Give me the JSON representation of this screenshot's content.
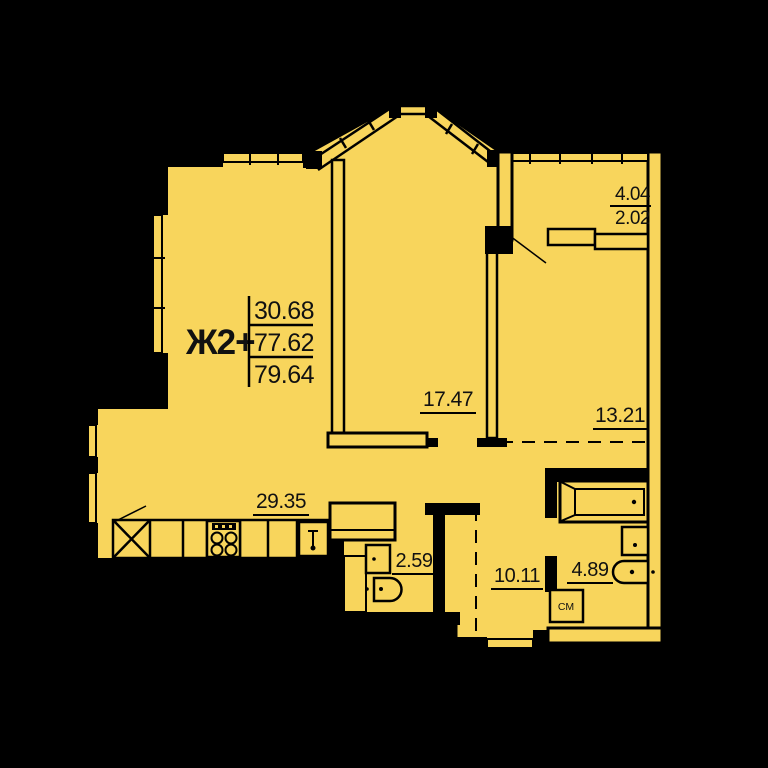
{
  "plan": {
    "apartment_label": "Ж2+",
    "area_summary": {
      "living": "30.68",
      "total": "77.62",
      "total_with_balcony": "79.64"
    },
    "rooms": [
      {
        "name": "bedroom-center",
        "area": "17.47"
      },
      {
        "name": "room-right",
        "area": "13.21"
      },
      {
        "name": "kitchen-living",
        "area": "29.35"
      },
      {
        "name": "wc",
        "area": "2.59"
      },
      {
        "name": "hallway",
        "area": "10.11"
      },
      {
        "name": "bathroom",
        "area": "4.89"
      },
      {
        "name": "balcony",
        "area_full": "4.04",
        "area_counted": "2.02"
      }
    ],
    "labels": {
      "washing_machine": "СМ"
    },
    "colors": {
      "floor_fill": "#F8D55C",
      "wall": "#000000",
      "background": "#000000"
    }
  }
}
